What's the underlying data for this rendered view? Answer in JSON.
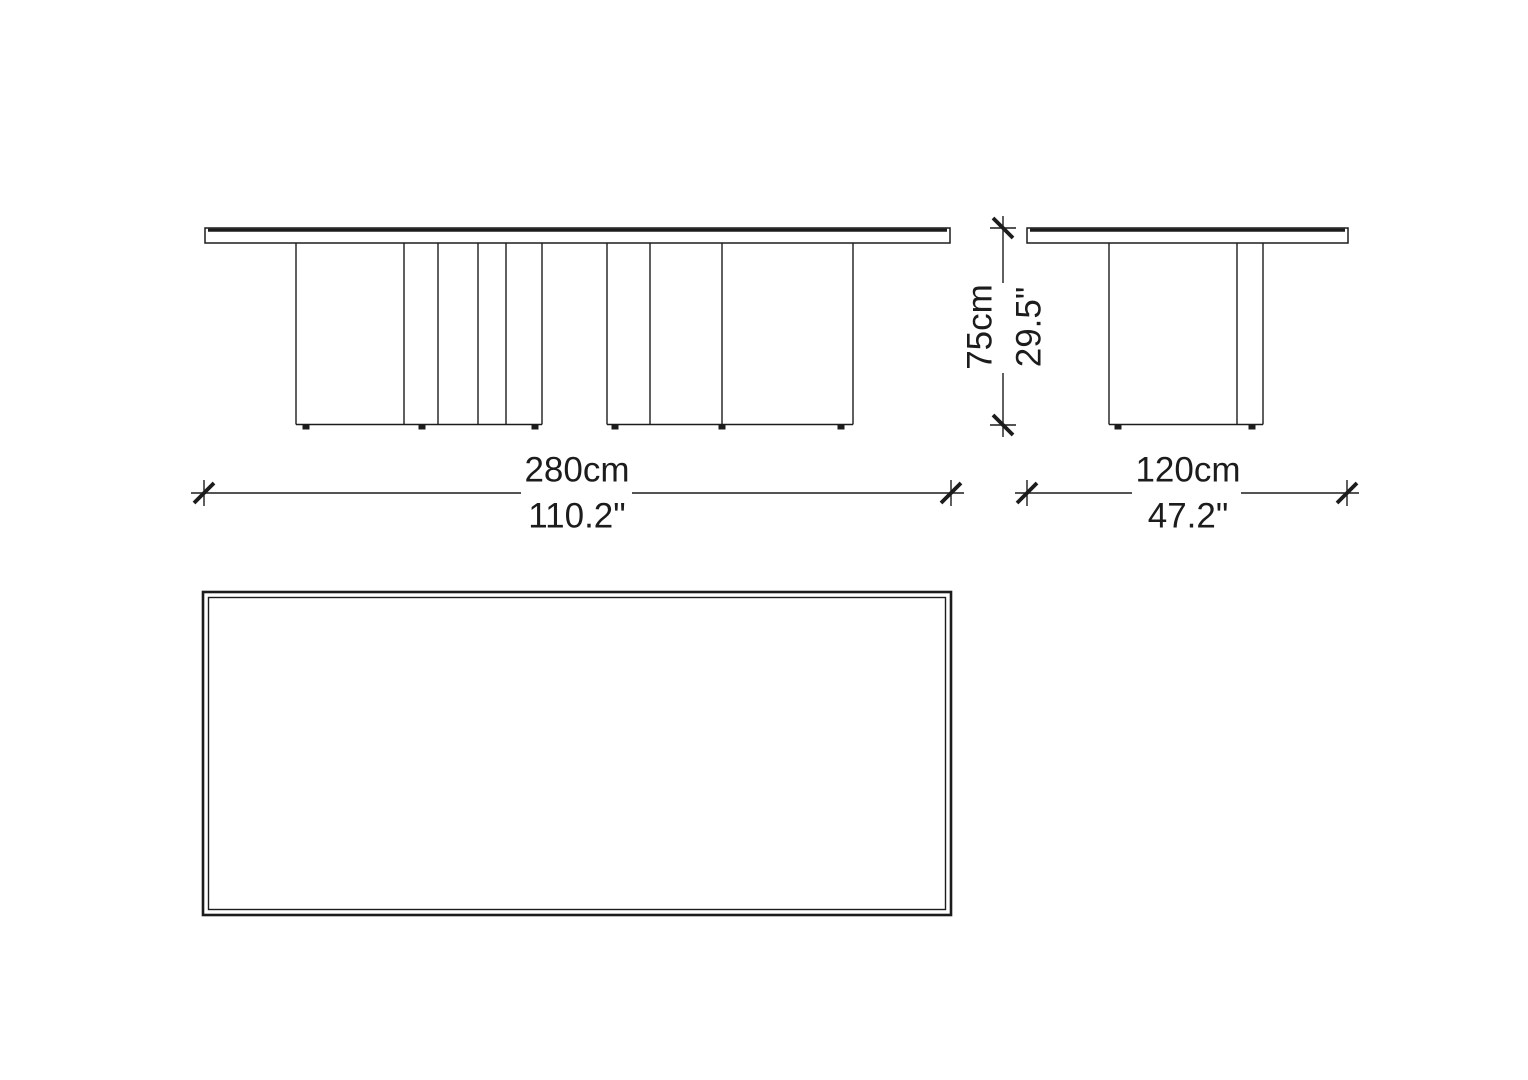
{
  "drawing": {
    "views": {
      "front": "front-elevation",
      "side": "side-elevation",
      "top": "plan-view"
    },
    "dimensions": {
      "width": {
        "metric": "280cm",
        "imperial": "110.2\""
      },
      "depth": {
        "metric": "120cm",
        "imperial": "47.2\""
      },
      "height": {
        "metric": "75cm",
        "imperial": "29.5\""
      }
    },
    "colors": {
      "line": "#1c1c1c",
      "background": "#ffffff"
    }
  }
}
